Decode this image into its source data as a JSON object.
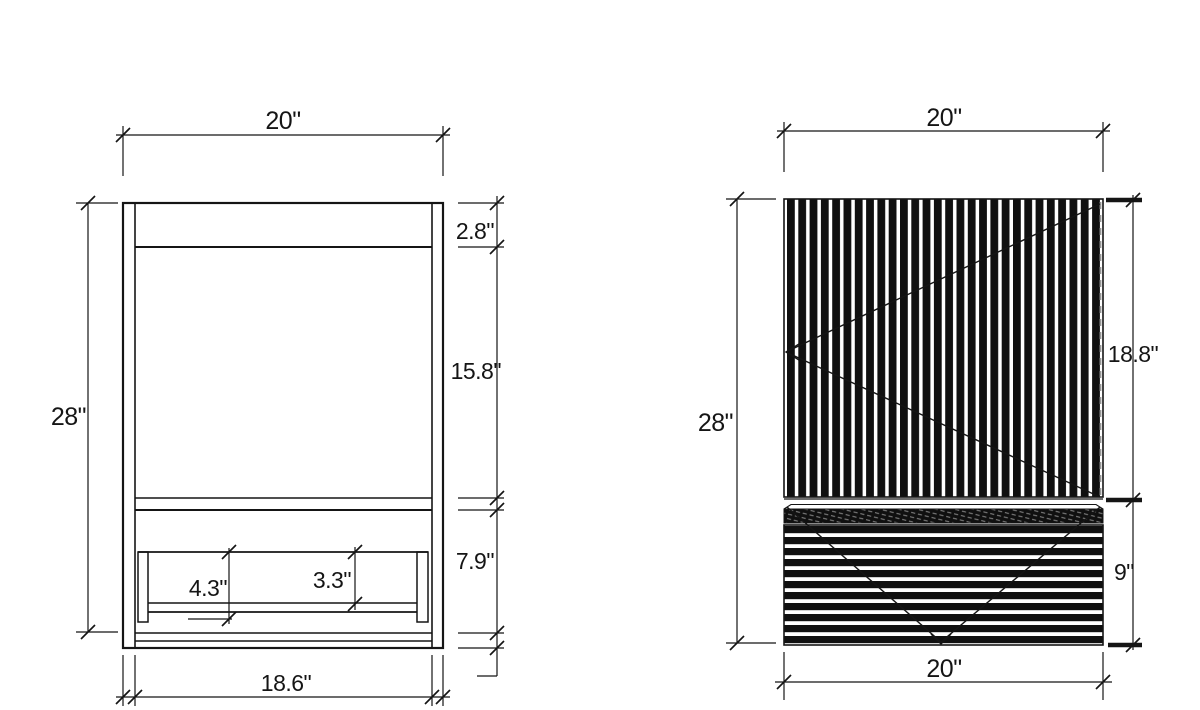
{
  "front_view": {
    "overall_width": "20\"",
    "overall_height": "28\"",
    "top_rail_height": "2.8\"",
    "opening_height": "15.8\"",
    "base_height": "7.9\"",
    "shelf_total_height": "4.3\"",
    "shelf_clear_height": "3.3\"",
    "inner_width": "18.6\""
  },
  "side_view": {
    "top_width": "20\"",
    "overall_height": "28\"",
    "upper_panel_height": "18.8\"",
    "lower_panel_height": "9\"",
    "bottom_width": "20\""
  },
  "colors": {
    "line": "#151515",
    "hidden_line": "#999999",
    "background": "#ffffff"
  }
}
